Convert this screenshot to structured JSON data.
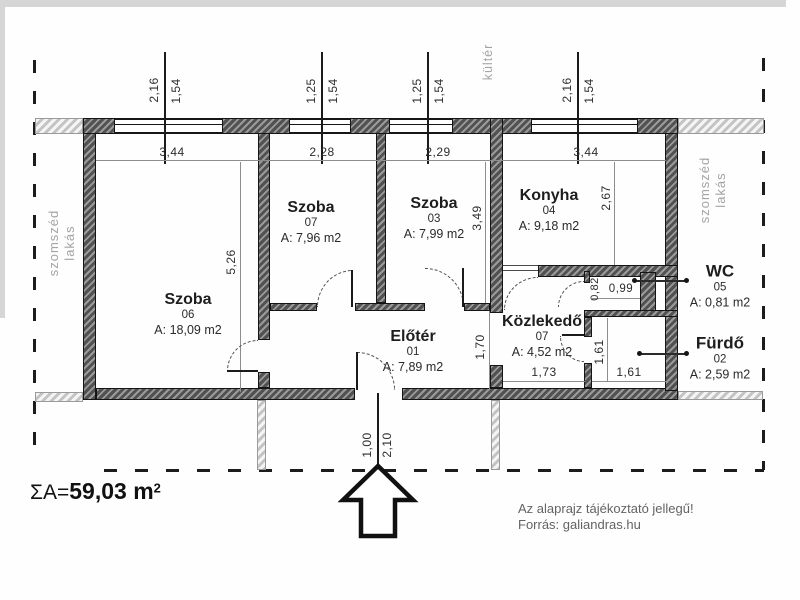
{
  "title": "floor-plan",
  "total": {
    "prefix": "ΣA=",
    "value": "59,03 m",
    "sup": "2"
  },
  "notes": {
    "line1": "Az alaprajz tájékoztató jellegű!",
    "line2": "Forrás: galiandras.hu"
  },
  "context": {
    "outside": "kültér",
    "neighbor_line1": "szomszéd",
    "neighbor_line2": "lakás"
  },
  "rooms": [
    {
      "name": "Szoba",
      "num": "06",
      "area": "A: 18,09 m2"
    },
    {
      "name": "Szoba",
      "num": "07",
      "area": "A: 7,96 m2"
    },
    {
      "name": "Szoba",
      "num": "03",
      "area": "A: 7,99 m2"
    },
    {
      "name": "Konyha",
      "num": "04",
      "area": "A: 9,18 m2"
    },
    {
      "name": "Előtér",
      "num": "01",
      "area": "A: 7,89 m2"
    },
    {
      "name": "Közlekedő",
      "num": "07",
      "area": "A: 4,52 m2"
    },
    {
      "name": "WC",
      "num": "05",
      "area": "A: 0,81 m2"
    },
    {
      "name": "Fürdő",
      "num": "02",
      "area": "A: 2,59 m2"
    }
  ],
  "window_dims": [
    {
      "w": "2,16",
      "h": "1,54"
    },
    {
      "w": "1,25",
      "h": "1,54"
    },
    {
      "w": "1,25",
      "h": "1,54"
    },
    {
      "w": "2,16",
      "h": "1,54"
    }
  ],
  "width_dims": [
    "3,44",
    "2,28",
    "2,29",
    "3,44"
  ],
  "dims": {
    "room6_h": "5,26",
    "room3_h": "3,49",
    "konyha_h": "2,67",
    "eloter_h": "1,70",
    "furdo_h": "1,61",
    "furdo_w": "1,61",
    "wc_h": "0,82",
    "wc_w": "0,99",
    "kozlekedo_w": "1,73",
    "door_w": "1,00",
    "door_h": "2,10"
  }
}
